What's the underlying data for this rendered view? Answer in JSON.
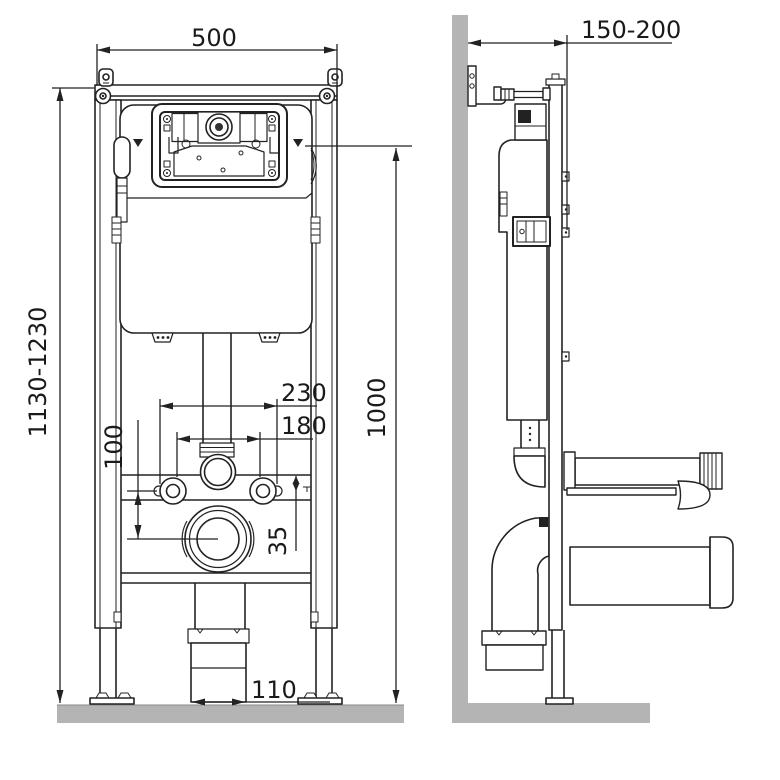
{
  "title": "wall-hung-toilet-installation-frame-drawing",
  "views": {
    "front": "front view",
    "side": "side view"
  },
  "dims": {
    "width": "500",
    "height_range": "1130-1230",
    "fixing_spacing_outer": "230",
    "fixing_spacing_inner": "180",
    "bolt_to_outlet": "100",
    "rail_offset": "35",
    "panel_axis_height": "1000",
    "outlet_width": "110",
    "depth_range": "150-200"
  },
  "colors": {
    "background": "#ffffff",
    "line": "#222222",
    "wall_fill": "#b4b4b4"
  }
}
